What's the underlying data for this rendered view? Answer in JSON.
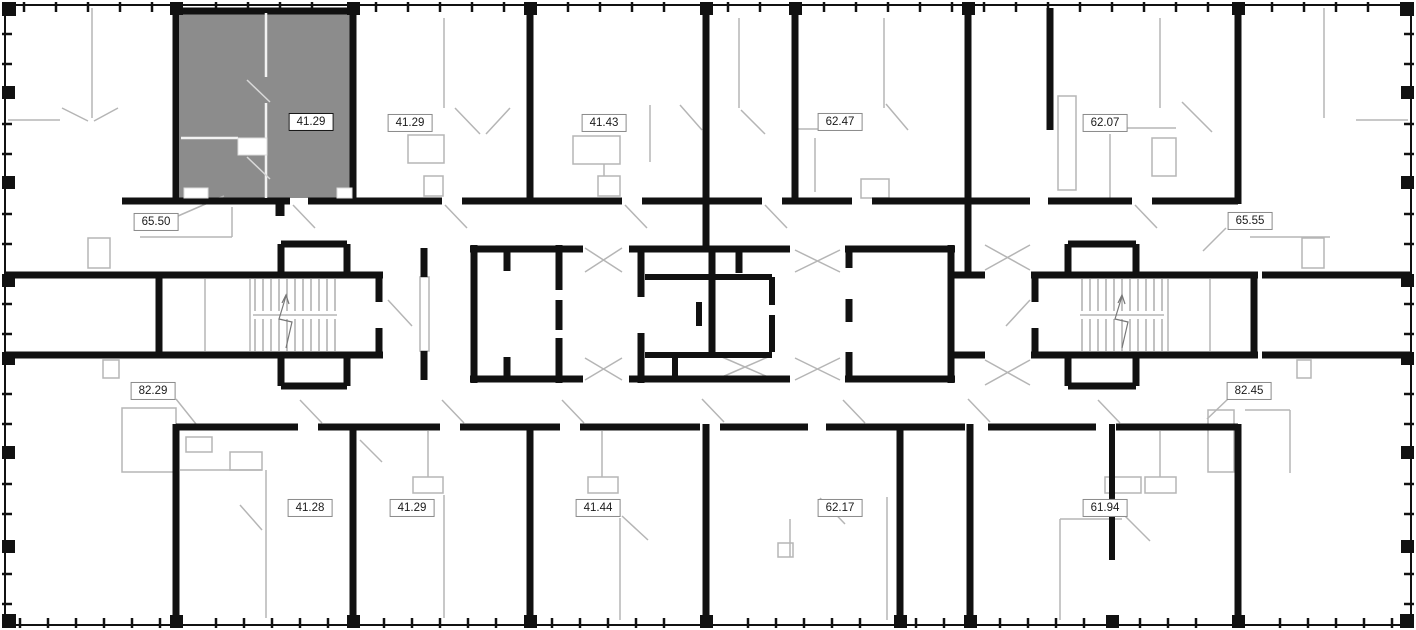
{
  "plan": {
    "type": "residential-floor-plan",
    "highlighted_apartment": {
      "area": "41.29",
      "position": "top-left"
    },
    "labels": [
      {
        "id": "top-1",
        "value": "41.29",
        "highlighted": true
      },
      {
        "id": "top-2",
        "value": "41.29",
        "highlighted": false
      },
      {
        "id": "top-3",
        "value": "41.43",
        "highlighted": false
      },
      {
        "id": "top-4",
        "value": "62.47",
        "highlighted": false
      },
      {
        "id": "top-5",
        "value": "62.07",
        "highlighted": false
      },
      {
        "id": "left-upper",
        "value": "65.50",
        "highlighted": false
      },
      {
        "id": "right-upper",
        "value": "65.55",
        "highlighted": false
      },
      {
        "id": "left-lower",
        "value": "82.29",
        "highlighted": false
      },
      {
        "id": "right-lower",
        "value": "82.45",
        "highlighted": false
      },
      {
        "id": "bottom-1",
        "value": "41.28",
        "highlighted": false
      },
      {
        "id": "bottom-2",
        "value": "41.29",
        "highlighted": false
      },
      {
        "id": "bottom-3",
        "value": "41.44",
        "highlighted": false
      },
      {
        "id": "bottom-4",
        "value": "62.17",
        "highlighted": false
      },
      {
        "id": "bottom-5",
        "value": "61.94",
        "highlighted": false
      }
    ],
    "colors": {
      "background": "#ffffff",
      "wall": "#111111",
      "thin_line": "#b5b5b5",
      "highlight_fill": "#8c8c8c",
      "label_border": "#8a8a8a",
      "label_border_highlighted": "#111111"
    }
  }
}
